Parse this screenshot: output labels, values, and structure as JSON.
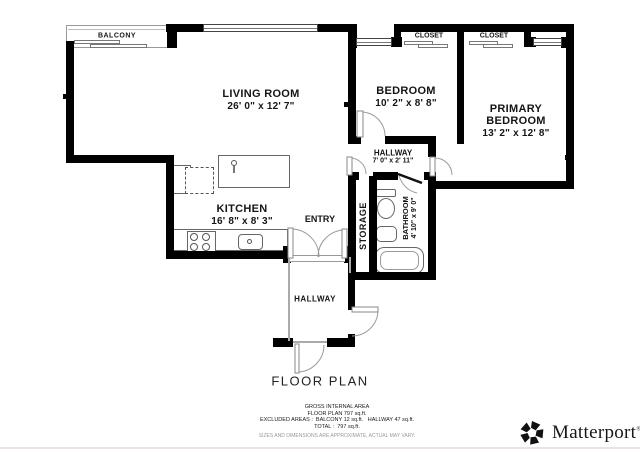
{
  "title": "FLOOR PLAN",
  "rooms": {
    "balcony": "BALCONY",
    "living_room": {
      "name": "LIVING ROOM",
      "dims": "26' 0\" x 12' 7\""
    },
    "kitchen": {
      "name": "KITCHEN",
      "dims": "16' 8\" x 8' 3\""
    },
    "entry": "ENTRY",
    "bedroom": {
      "name": "BEDROOM",
      "dims": "10' 2\" x 8' 8\""
    },
    "primary_bedroom": {
      "name": "PRIMARY BEDROOM",
      "dims": "13' 2\" x 12' 8\""
    },
    "closet_left": "CLOSET",
    "closet_right": "CLOSET",
    "hallway_upper": {
      "name": "HALLWAY",
      "dims": "7' 0\" x 2' 11\""
    },
    "hallway_lower": "HALLWAY",
    "storage": "STORAGE",
    "bathroom": {
      "name": "BATHROOM",
      "dims": "4' 10\" x 9' 0\""
    }
  },
  "footer": {
    "area_title": "GROSS INTERNAL AREA",
    "area_line": "FLOOR PLAN 797 sq.ft.",
    "excluded_line": "EXCLUDED AREAS :  BALCONY 12 sq.ft.   HALLWAY 47 sq.ft.",
    "total_line": "TOTAL :  797 sq.ft.",
    "disclaimer": "SIZES AND DIMENSIONS ARE APPROXIMATE, ACTUAL MAY VARY."
  },
  "brand": {
    "name": "Matterport",
    "registered": "®"
  },
  "colors": {
    "wall": "#000000",
    "thin_line": "#999999",
    "text": "#151515",
    "disclaimer": "#999999"
  }
}
